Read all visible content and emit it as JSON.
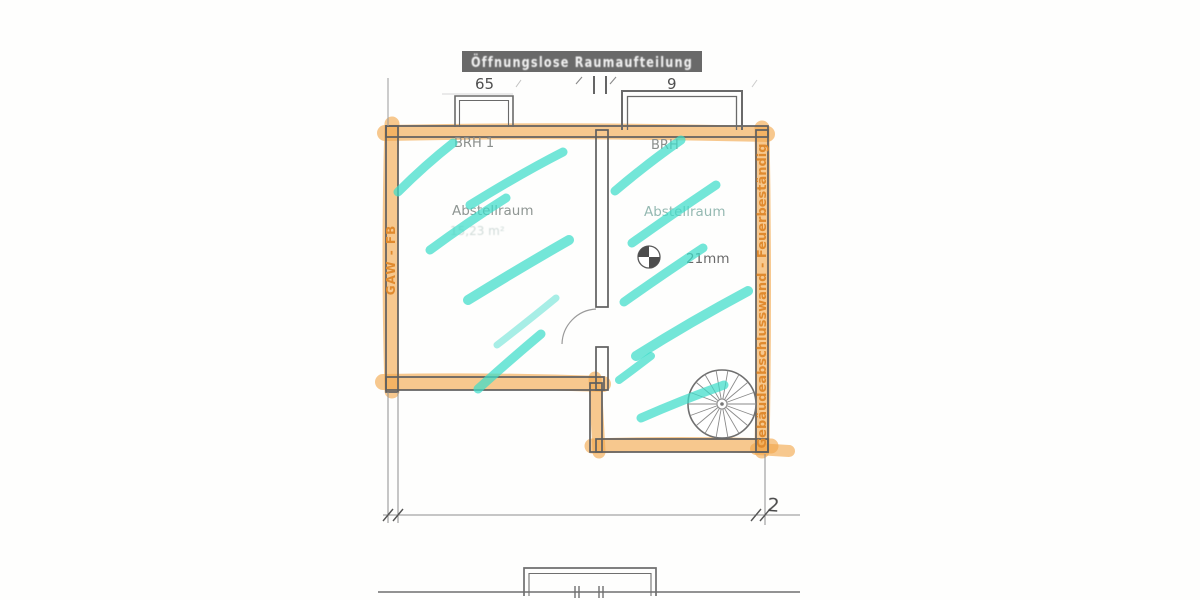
{
  "drawing": {
    "title_banner": "Öffnungslose Raumaufteilung",
    "dims": {
      "top_left": "65",
      "top_right": "9",
      "bottom_right": "2"
    },
    "left_room": {
      "brh_label": "BRH 1",
      "name": "Abstellraum",
      "area": "15,23 m²"
    },
    "right_room": {
      "brh_label": "BRH",
      "name": "Abstellraum",
      "annotation": "21mm"
    },
    "wall_labels": {
      "left": "GAW - FB",
      "right": "Gebäudeabschlusswand - Feuerbeständig"
    },
    "colors": {
      "highlight_orange": "#f2a64b",
      "marker_teal": "#3ddcc9",
      "wall_gray": "#5f5f5f",
      "banner_bg": "#696969",
      "banner_text": "#f2f2f2",
      "label_orange": "#e08a2e"
    }
  }
}
